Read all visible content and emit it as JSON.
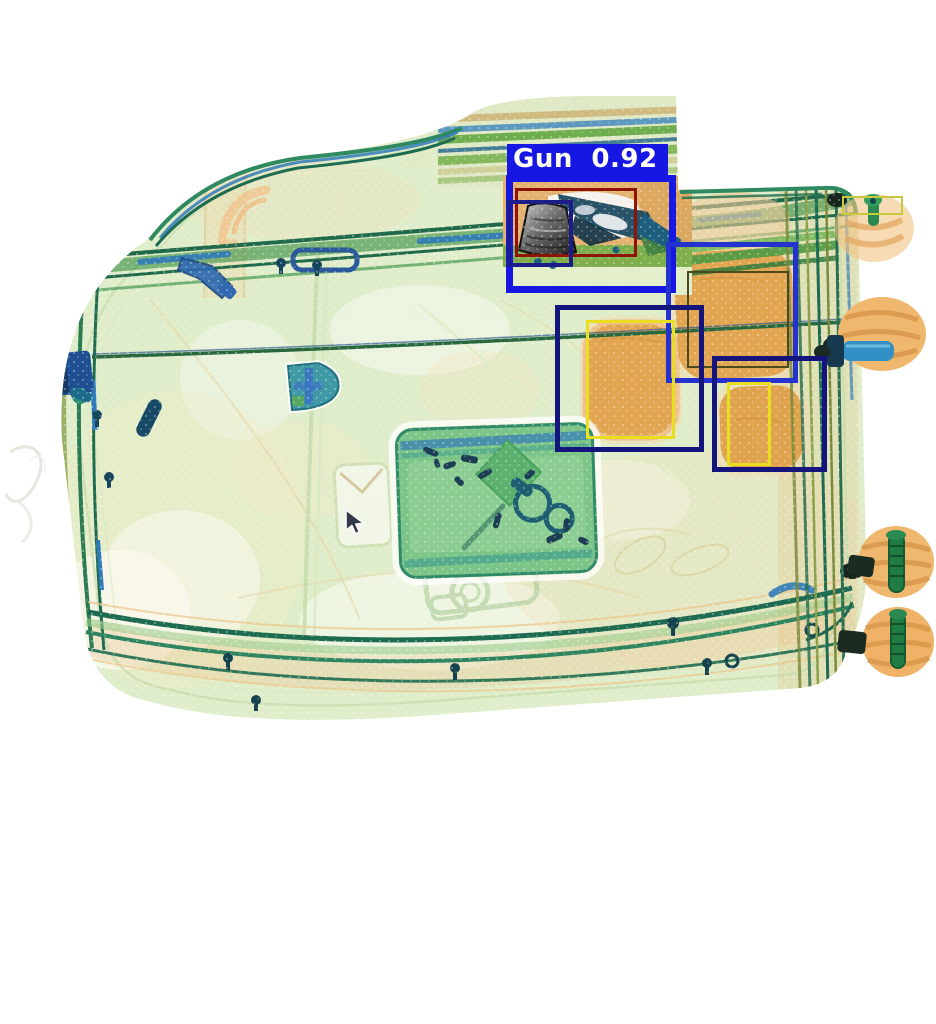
{
  "scene": {
    "description": "X-ray baggage scan of a suitcase with object-detection overlay",
    "background_color": "#ffffff"
  },
  "detection": {
    "label": "Gun",
    "confidence": "0.92",
    "display_text": "Gun 0.92",
    "label_bg_color": "#1617e3",
    "label_text_color": "#ffffff",
    "label_pos": {
      "left": 507,
      "top": 144,
      "min_width": 151,
      "height": 31
    }
  },
  "boxes": [
    {
      "name": "gun-detection-box",
      "x": 506,
      "y": 175,
      "w": 170,
      "h": 118,
      "color": "#1617e3",
      "stroke": 7
    },
    {
      "name": "gun-inner-red-box",
      "x": 515,
      "y": 188,
      "w": 122,
      "h": 69,
      "color": "#8f1407",
      "stroke": 3
    },
    {
      "name": "gun-inner-navy-box",
      "x": 507,
      "y": 200,
      "w": 66,
      "h": 67,
      "color": "#1d1d8a",
      "stroke": 4
    },
    {
      "name": "royal-blue-box",
      "x": 666,
      "y": 242,
      "w": 132,
      "h": 141,
      "color": "#2433cf",
      "stroke": 5
    },
    {
      "name": "thin-olive-box",
      "x": 687,
      "y": 271,
      "w": 102,
      "h": 97,
      "color": "#4b4a1e",
      "stroke": 2
    },
    {
      "name": "navy-box-left",
      "x": 555,
      "y": 305,
      "w": 149,
      "h": 147,
      "color": "#14147d",
      "stroke": 5
    },
    {
      "name": "yellow-box-left",
      "x": 586,
      "y": 320,
      "w": 89,
      "h": 119,
      "color": "#e9de20",
      "stroke": 3
    },
    {
      "name": "navy-box-right",
      "x": 712,
      "y": 356,
      "w": 115,
      "h": 116,
      "color": "#14147d",
      "stroke": 5
    },
    {
      "name": "yellow-box-right",
      "x": 727,
      "y": 382,
      "w": 44,
      "h": 84,
      "color": "#e9de20",
      "stroke": 3
    },
    {
      "name": "small-yellow-box-topright",
      "x": 842,
      "y": 196,
      "w": 61,
      "h": 19,
      "color": "#c9c940",
      "stroke": 2
    }
  ],
  "cursor": {
    "name": "arrow-cursor",
    "left": 344,
    "top": 508
  },
  "palette": {
    "case_fill": "#e0edca",
    "case_edge_teal": "#1d6b50",
    "case_edge_green": "#57a35f",
    "organic_orange": "#e2a24c",
    "metal_blue": "#2f7ab8",
    "pouch_green": "#7cc488"
  }
}
